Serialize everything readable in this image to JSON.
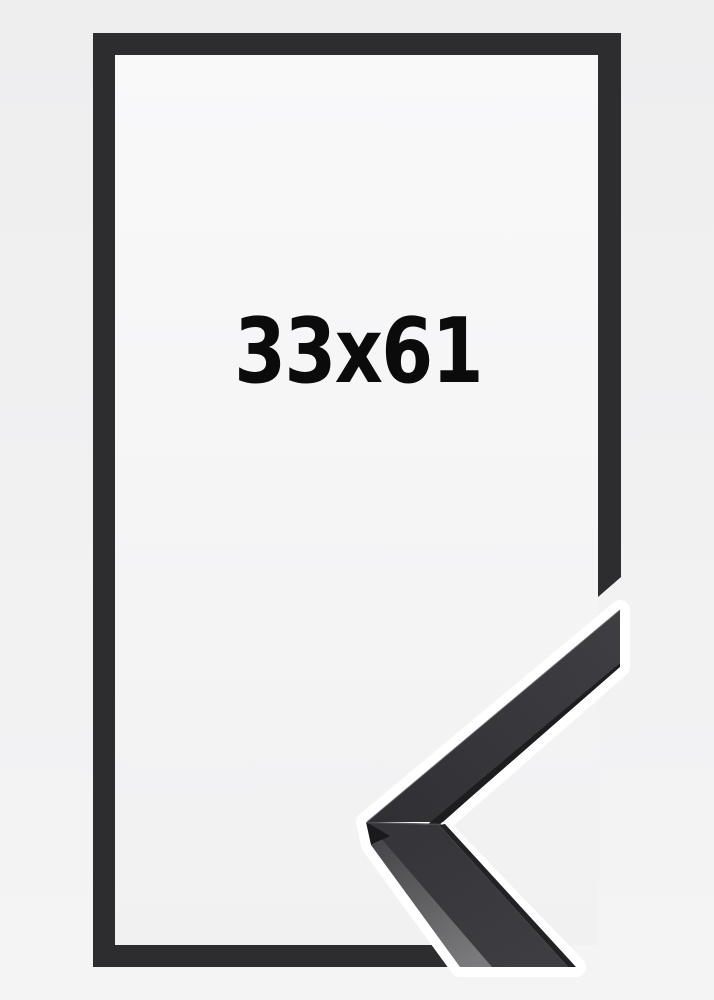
{
  "product": {
    "size_label": "33x61",
    "description": "Black picture frame shown front-on with a 3D moulding corner sample overlapping the lower right corner"
  },
  "colors": {
    "background_top": "#eeeeef",
    "background_bottom": "#f4f4f5",
    "frame": "#2d2d30",
    "interior_top": "#f9f9fa",
    "interior_bottom": "#f1f1f2",
    "halo": "#ffffff",
    "moulding_face_light": "#3f3f43",
    "moulding_face_dark": "#303034",
    "moulding_face_lower_top": "#36363a",
    "moulding_face_lower_bottom": "#3e3e42",
    "moulding_edge_dark": "#1d1d20",
    "moulding_lip_dark": "#222225",
    "moulding_side_top": "#47474b",
    "moulding_side_bottom": "#7a7a7c",
    "moulding_tip_facet": "#1a1a1d",
    "label_text": "#0b0b0b"
  }
}
